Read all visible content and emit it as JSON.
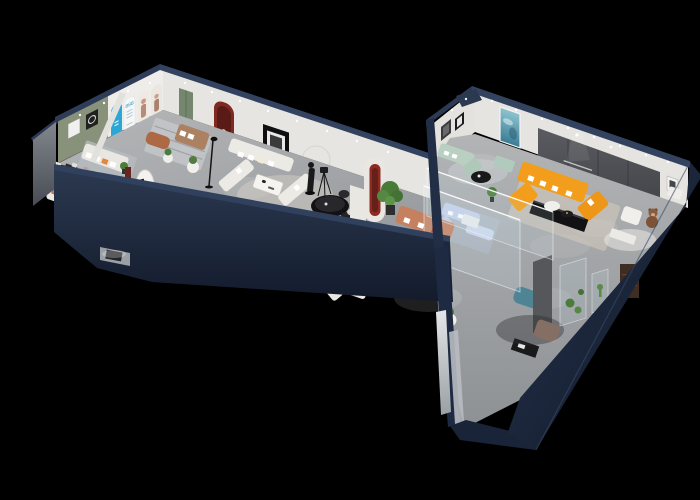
{
  "scene": {
    "type": "3d-isometric-showroom-render",
    "description": "Isometric cutaway dollhouse view of a two-wing furniture showroom floor plan on a black background",
    "background_color": "#000000"
  },
  "palette": {
    "outer_wall_navy": "#1c2840",
    "wall_top_navy": "#33435f",
    "floor_gray": "#aaacae",
    "interior_wall_white": "#e7e5e1",
    "accent_green_wall": "#88917a",
    "accent_dark_wall": "#4e5055",
    "sofa_orange": "#f29e1c",
    "sofa_mint": "#b9cfc2",
    "sofa_terracotta": "#c5805f",
    "sofa_white": "#edebe6",
    "sofa_tan": "#ab8162",
    "poster_blue": "#2aa7d6",
    "arch_red": "#7e2a22",
    "plant_green": "#4c7c3c",
    "rug_cream": "#d9d0c0",
    "table_black": "#141416",
    "glass": "rgba(205,228,240,0.15)"
  },
  "left_wing": {
    "posters": {
      "arch_poster_headline": "888"
    },
    "rooms": [
      {
        "name": "media-room",
        "furniture": [
          "white daybed",
          "black console",
          "white chair",
          "dark wall shelf",
          "white cabinet"
        ]
      },
      {
        "name": "green-lounge",
        "furniture": [
          "white sofa",
          "black coffee table",
          "plant",
          "brown armchair",
          "black desk",
          "blue rug",
          "oval brand sign",
          "red slat panel"
        ]
      },
      {
        "name": "arch-gallery",
        "wall_displays": [
          "blue arch panel",
          "arch poster 888",
          "model poster",
          "model poster",
          "green door",
          "red arch niche",
          "black framed art"
        ],
        "furniture": [
          "copper ottoman",
          "tan sofa",
          "striped rug",
          "round side tables",
          "floor lamp"
        ]
      }
    ]
  },
  "junction": {
    "furniture": [
      "white u-shaped sectional",
      "white coffee table",
      "black dining table",
      "dining chairs",
      "bronze statue",
      "wall ring",
      "camera tripod",
      "orange armchair",
      "red arch sculpture",
      "white pillar"
    ]
  },
  "right_wing": {
    "rooms": [
      {
        "name": "glass-bedroom-display",
        "furniture": [
          "mint sofa",
          "mint bench",
          "black round coffee table"
        ],
        "art": [
          "teal abstract painting",
          "dark framed art"
        ]
      },
      {
        "name": "main-lounge",
        "wall": "dark slogan wall",
        "furniture": [
          "orange sectional sofa",
          "black tv console",
          "white round table",
          "black tray table",
          "cream rug",
          "white armchair",
          "teddy bear mascot",
          "white console"
        ]
      },
      {
        "name": "glass-display-room",
        "furniture": [
          "periwinkle sofa set",
          "white coffee table"
        ]
      },
      {
        "name": "south-lounge",
        "furniture": [
          "terracotta sofa",
          "black oval coffee table",
          "white armchair",
          "potted tree",
          "white sofa",
          "side table with plant",
          "teal pouf",
          "blush armchair",
          "black low table",
          "gray column",
          "mirror panels",
          "glass plant cases",
          "brown cabinet"
        ]
      }
    ]
  }
}
